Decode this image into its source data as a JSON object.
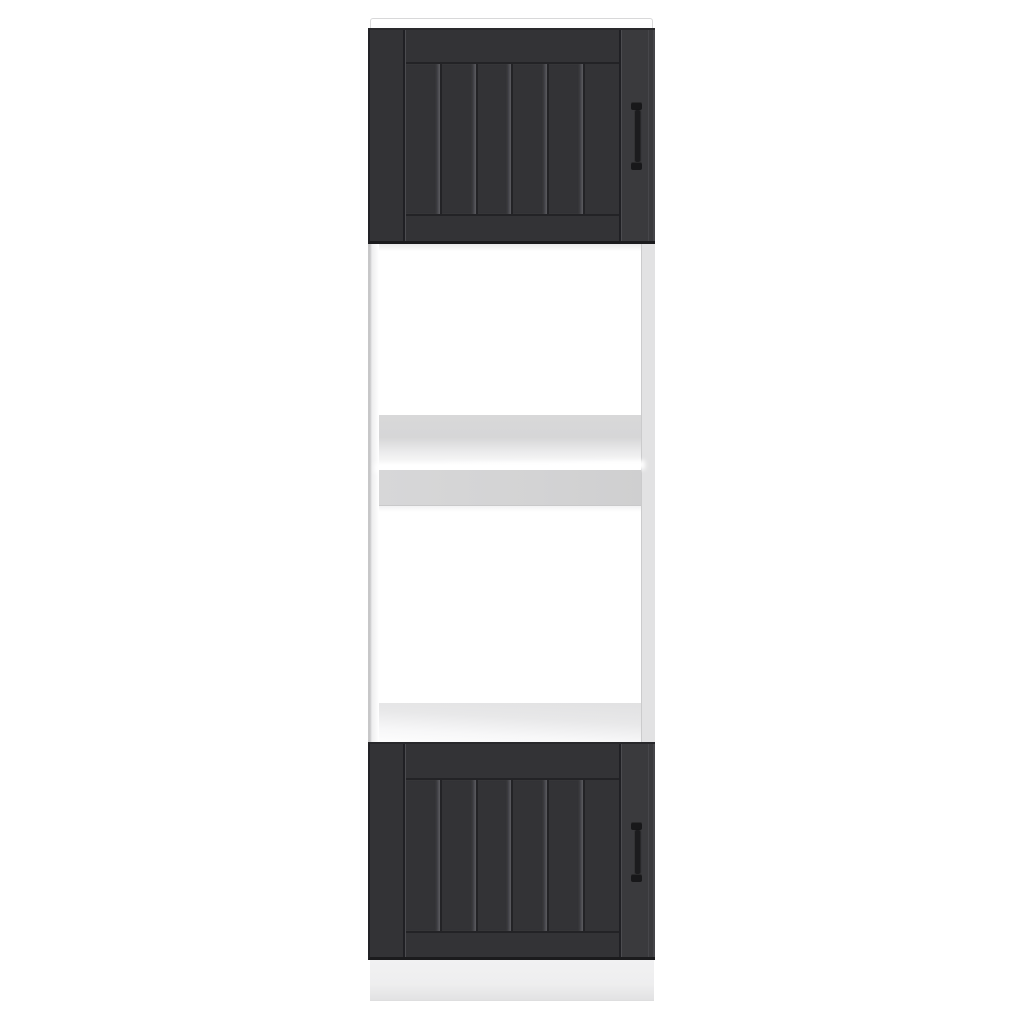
{
  "scene": {
    "description": "Product photograph of a tall dark-grey and white kitchen cabinet on a plain white background",
    "subject": "tall kitchen storage cabinet with two beadboard doors, two open appliance compartments, top panel and plinth"
  },
  "cabinet": {
    "upper_door": {
      "style": "shaker frame with six vertical beadboard planks",
      "handle": "vertical bar handle, right side"
    },
    "lower_door": {
      "style": "shaker frame with six vertical beadboard planks",
      "handle": "vertical bar handle, right side"
    },
    "open_section": {
      "compartments": 2,
      "shelves": 2,
      "finish": "white"
    }
  },
  "colors": {
    "background": "#ffffff",
    "door_face": "#333336",
    "door_face_light": "#3a3a3d",
    "door_groove": "#232326",
    "door_groove_highlight": "#4c4c50",
    "door_edge_dark": "#1b1b1d",
    "door_joint_dark": "#202024",
    "handle": "#1c1c1e",
    "handle_cap": "#18181a",
    "carcass_edge": "#c7c7c8",
    "side_strip": "#e2e2e3",
    "side_strip_line": "#cbcbcc",
    "shelf_grey": "#d6d6d7",
    "shelf_front": "#d3d3d4",
    "plinth": "#eeeeef",
    "plinth_shade": "#e2e2e3",
    "top_panel": "#fbfbfc",
    "top_panel_line": "#d8d8d9"
  }
}
